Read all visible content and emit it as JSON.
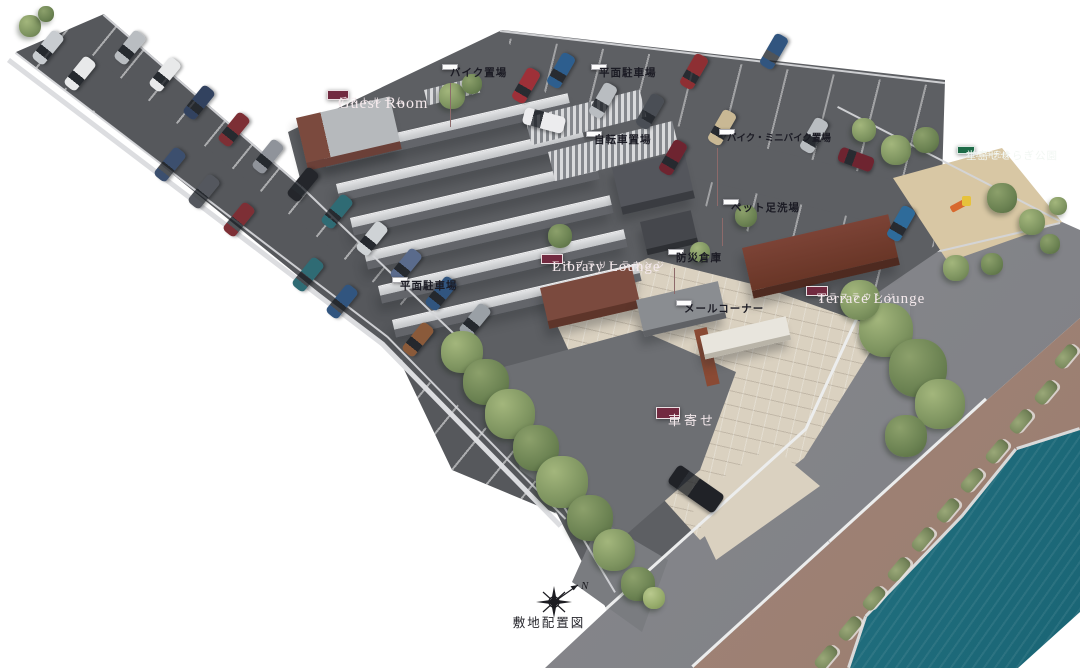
{
  "title": {
    "caption": "敷地配置図",
    "compass_north": "N"
  },
  "colors": {
    "maroon": "#722a40",
    "green": "#1e6b48",
    "asphalt": "#56585c",
    "asphalt_light": "#5d5f63",
    "road": "#87888c",
    "promenade": "#a28679",
    "water_light": "#38919e",
    "water_deep": "#1a6575",
    "paving": "#dad1c0",
    "sand": "#d8c7a4"
  },
  "labels": {
    "guest_room": {
      "en": "Guest Room",
      "ja": "ゲストルーム"
    },
    "library_lounge": {
      "en": "Library Lounge",
      "ja": "ライブラリーラウンジ"
    },
    "terrace_lounge": {
      "en": "Terrace Lounge",
      "ja": "テラスラウンジ"
    },
    "porte_cochere": "車寄せ",
    "bike_parking": "バイク置場",
    "surface_parking_north": "平面駐車場",
    "surface_parking_west": "平面駐車場",
    "bicycle_parking": "自転車置場",
    "moto_minibike_parking": "バイク・ミニバイク置場",
    "pet_foot_wash": "ペット足洗場",
    "disaster_storage": "防災倉庫",
    "mail_corner": "メールコーナー",
    "park": {
      "year_note": "2025年完成",
      "name": "堂島せせらぎ公園"
    }
  }
}
